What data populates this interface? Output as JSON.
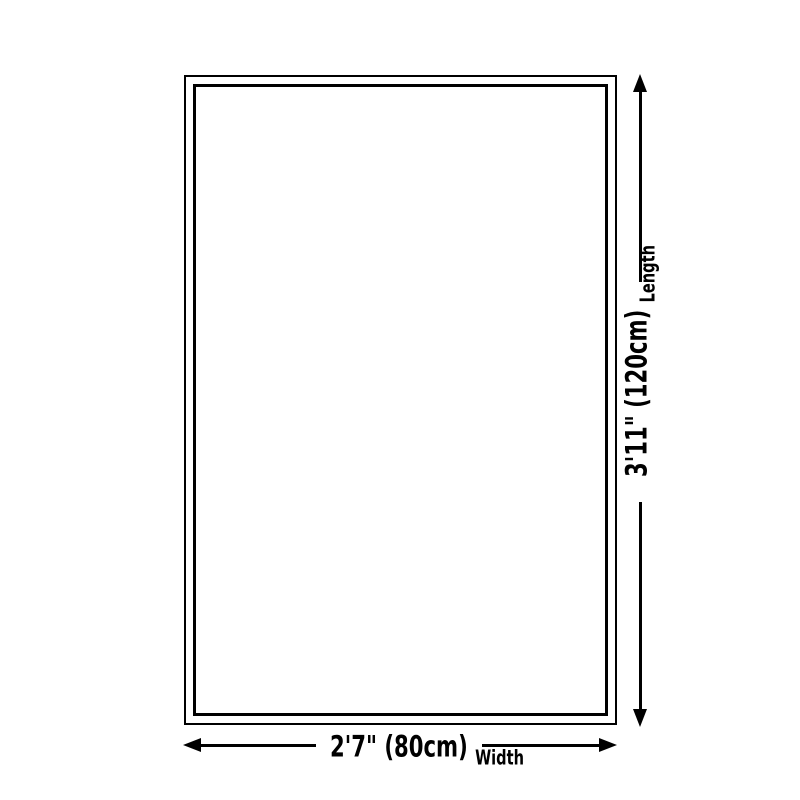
{
  "diagram": {
    "background_color": "#ffffff",
    "line_color": "#000000",
    "length": {
      "measurement": "3'11\" (120cm)",
      "label": "Length"
    },
    "width": {
      "measurement": "2'7\" (80cm)",
      "label": "Width"
    }
  }
}
